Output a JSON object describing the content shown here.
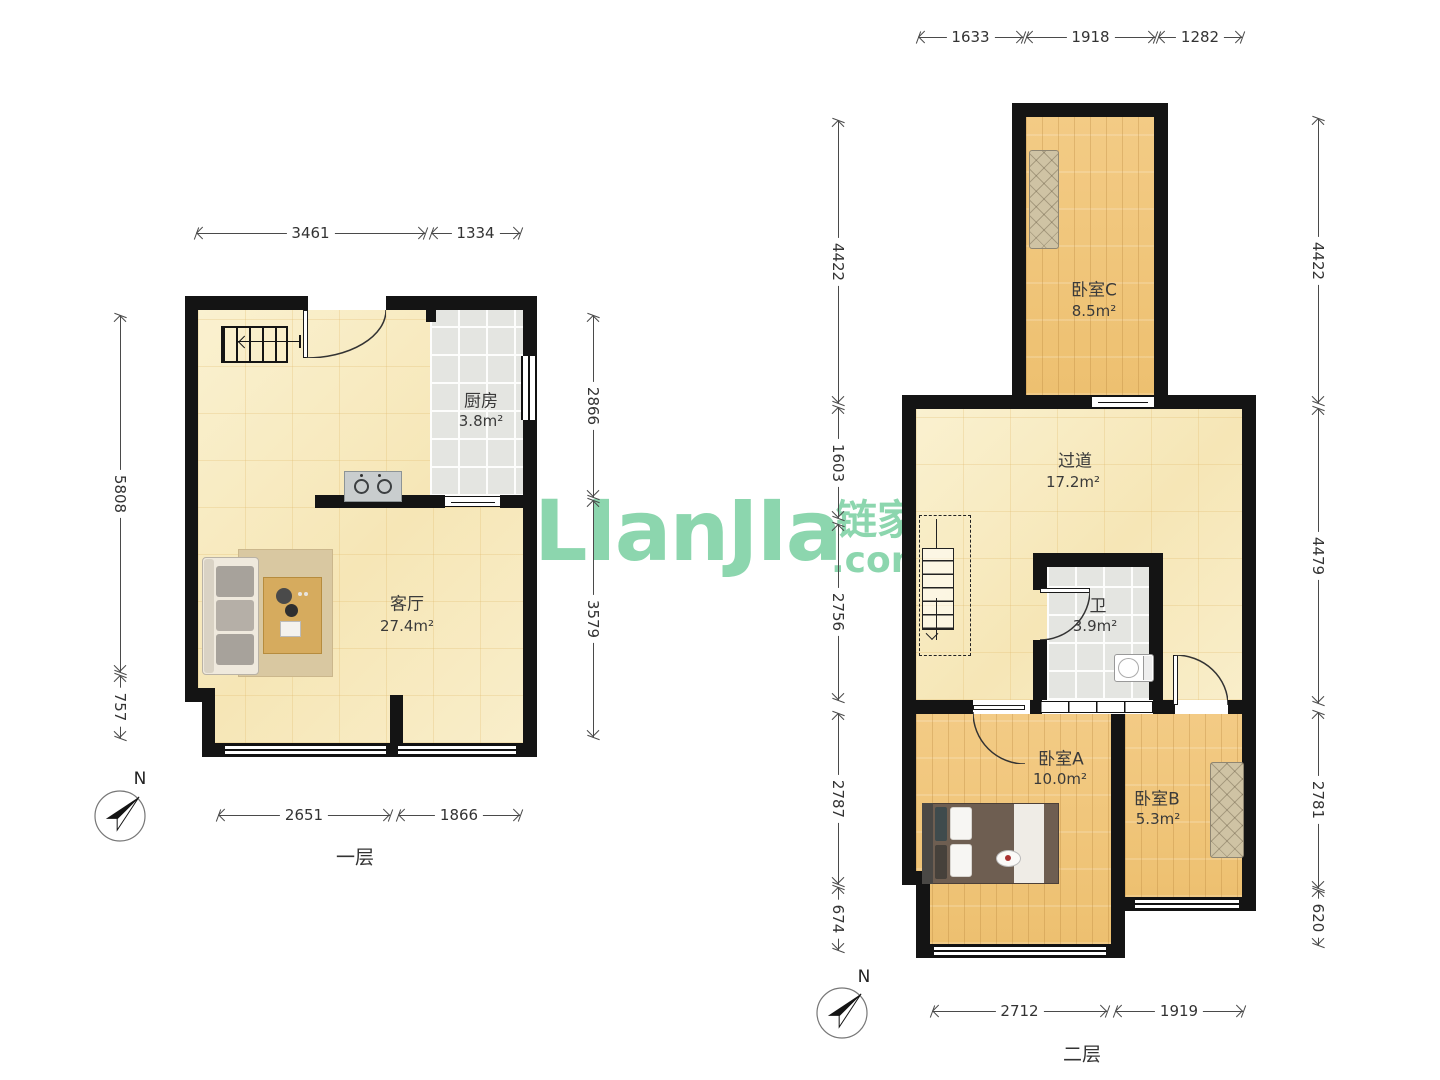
{
  "watermark": {
    "brand": "LIanJIa",
    "cn": "链家",
    "tld": ".com"
  },
  "floor1": {
    "label": "一层",
    "compass": "N",
    "kitchen": {
      "name": "厨房",
      "area": "3.8m²"
    },
    "living": {
      "name": "客厅",
      "area": "27.4m²"
    },
    "dims": {
      "top": [
        "3461",
        "1334"
      ],
      "left": [
        "5808",
        "757"
      ],
      "right": [
        "2866",
        "3579"
      ],
      "bottom": [
        "2651",
        "1866"
      ]
    }
  },
  "floor2": {
    "label": "二层",
    "compass": "N",
    "bedroomC": {
      "name": "卧室C",
      "area": "8.5m²"
    },
    "hallway": {
      "name": "过道",
      "area": "17.2m²"
    },
    "bath": {
      "name": "卫",
      "area": "3.9m²"
    },
    "bedroomA": {
      "name": "卧室A",
      "area": "10.0m²"
    },
    "bedroomB": {
      "name": "卧室B",
      "area": "5.3m²"
    },
    "dims": {
      "top": [
        "1633",
        "1918",
        "1282"
      ],
      "left": [
        "4422",
        "1603",
        "2756",
        "2787",
        "674"
      ],
      "right": [
        "4422",
        "4479",
        "2781",
        "620"
      ],
      "bottom": [
        "2712",
        "1919"
      ]
    }
  }
}
